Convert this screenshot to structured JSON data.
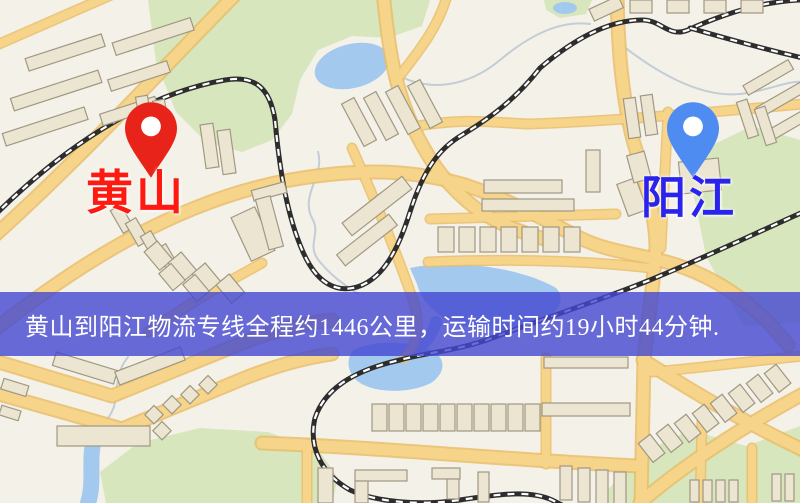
{
  "window": {
    "width": 800,
    "height": 503
  },
  "map": {
    "origin_marker": {
      "name": "黄山",
      "pin_color": "#e8241a",
      "label_color": "#fe1911"
    },
    "destination_marker": {
      "name": "阳江",
      "pin_color": "#4f8cf2",
      "label_color": "#2a23ee"
    }
  },
  "banner": {
    "text": "黄山到阳江物流专线全程约1446公里，运输时间约19小时44分钟.",
    "text_color": "#ffffff",
    "background_color": "rgba(67,71,209,0.8)"
  },
  "route": {
    "from": "黄山",
    "to": "阳江",
    "distance_text": "约1446公里",
    "duration_text": "约19小时44分钟"
  },
  "colors": {
    "map-bg": "#f4f1e9",
    "road": "#f6d489",
    "road-casing": "#e9bd69",
    "water": "#a3c9ee",
    "greenery": "#d7e6bd",
    "building": "#ebe5d2",
    "building-outline": "#a09882",
    "railway": "#2d2d2d",
    "stream": "#c2cdd6",
    "banner-bg": "rgba(67,71,209,0.8)",
    "banner-text": "#ffffff",
    "origin-pin": "#e8241a",
    "origin-label": "#fe1911",
    "destination-pin": "#4f8cf2",
    "destination-label": "#2a23ee"
  }
}
